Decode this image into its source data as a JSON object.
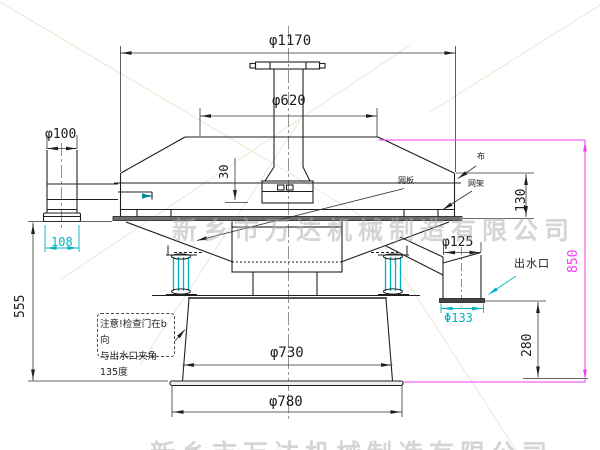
{
  "drawing": {
    "title_hint": "rotary vibrating filter sieve - section drawing",
    "watermark": "新乡市万达机械制造有限公司",
    "note": {
      "line1": "注意!检查门在b向",
      "line2": "与出水口夹角135度"
    },
    "labels": {
      "outlet": "出水口",
      "mesh_cloth": "布",
      "mesh_plate": "网板",
      "mesh_frame": "网架"
    },
    "dims": {
      "top_flange": "φ1170",
      "cover": "φ620",
      "inlet": "φ100",
      "inlet_flange": "108",
      "offset_30": "30",
      "deck_height": "130",
      "left_height": "555",
      "total_height": "850",
      "outlet_height": "280",
      "outlet_pipe": "φ125",
      "outlet_flange": "Φ133",
      "base_top": "φ730",
      "base": "φ780"
    },
    "colors": {
      "line": "#1f1f1f",
      "aux_cyan": "#00b4bd",
      "aux_magenta": "#f23cf2",
      "watermark": "#acacac",
      "fold_line": "#ece6d2"
    }
  }
}
